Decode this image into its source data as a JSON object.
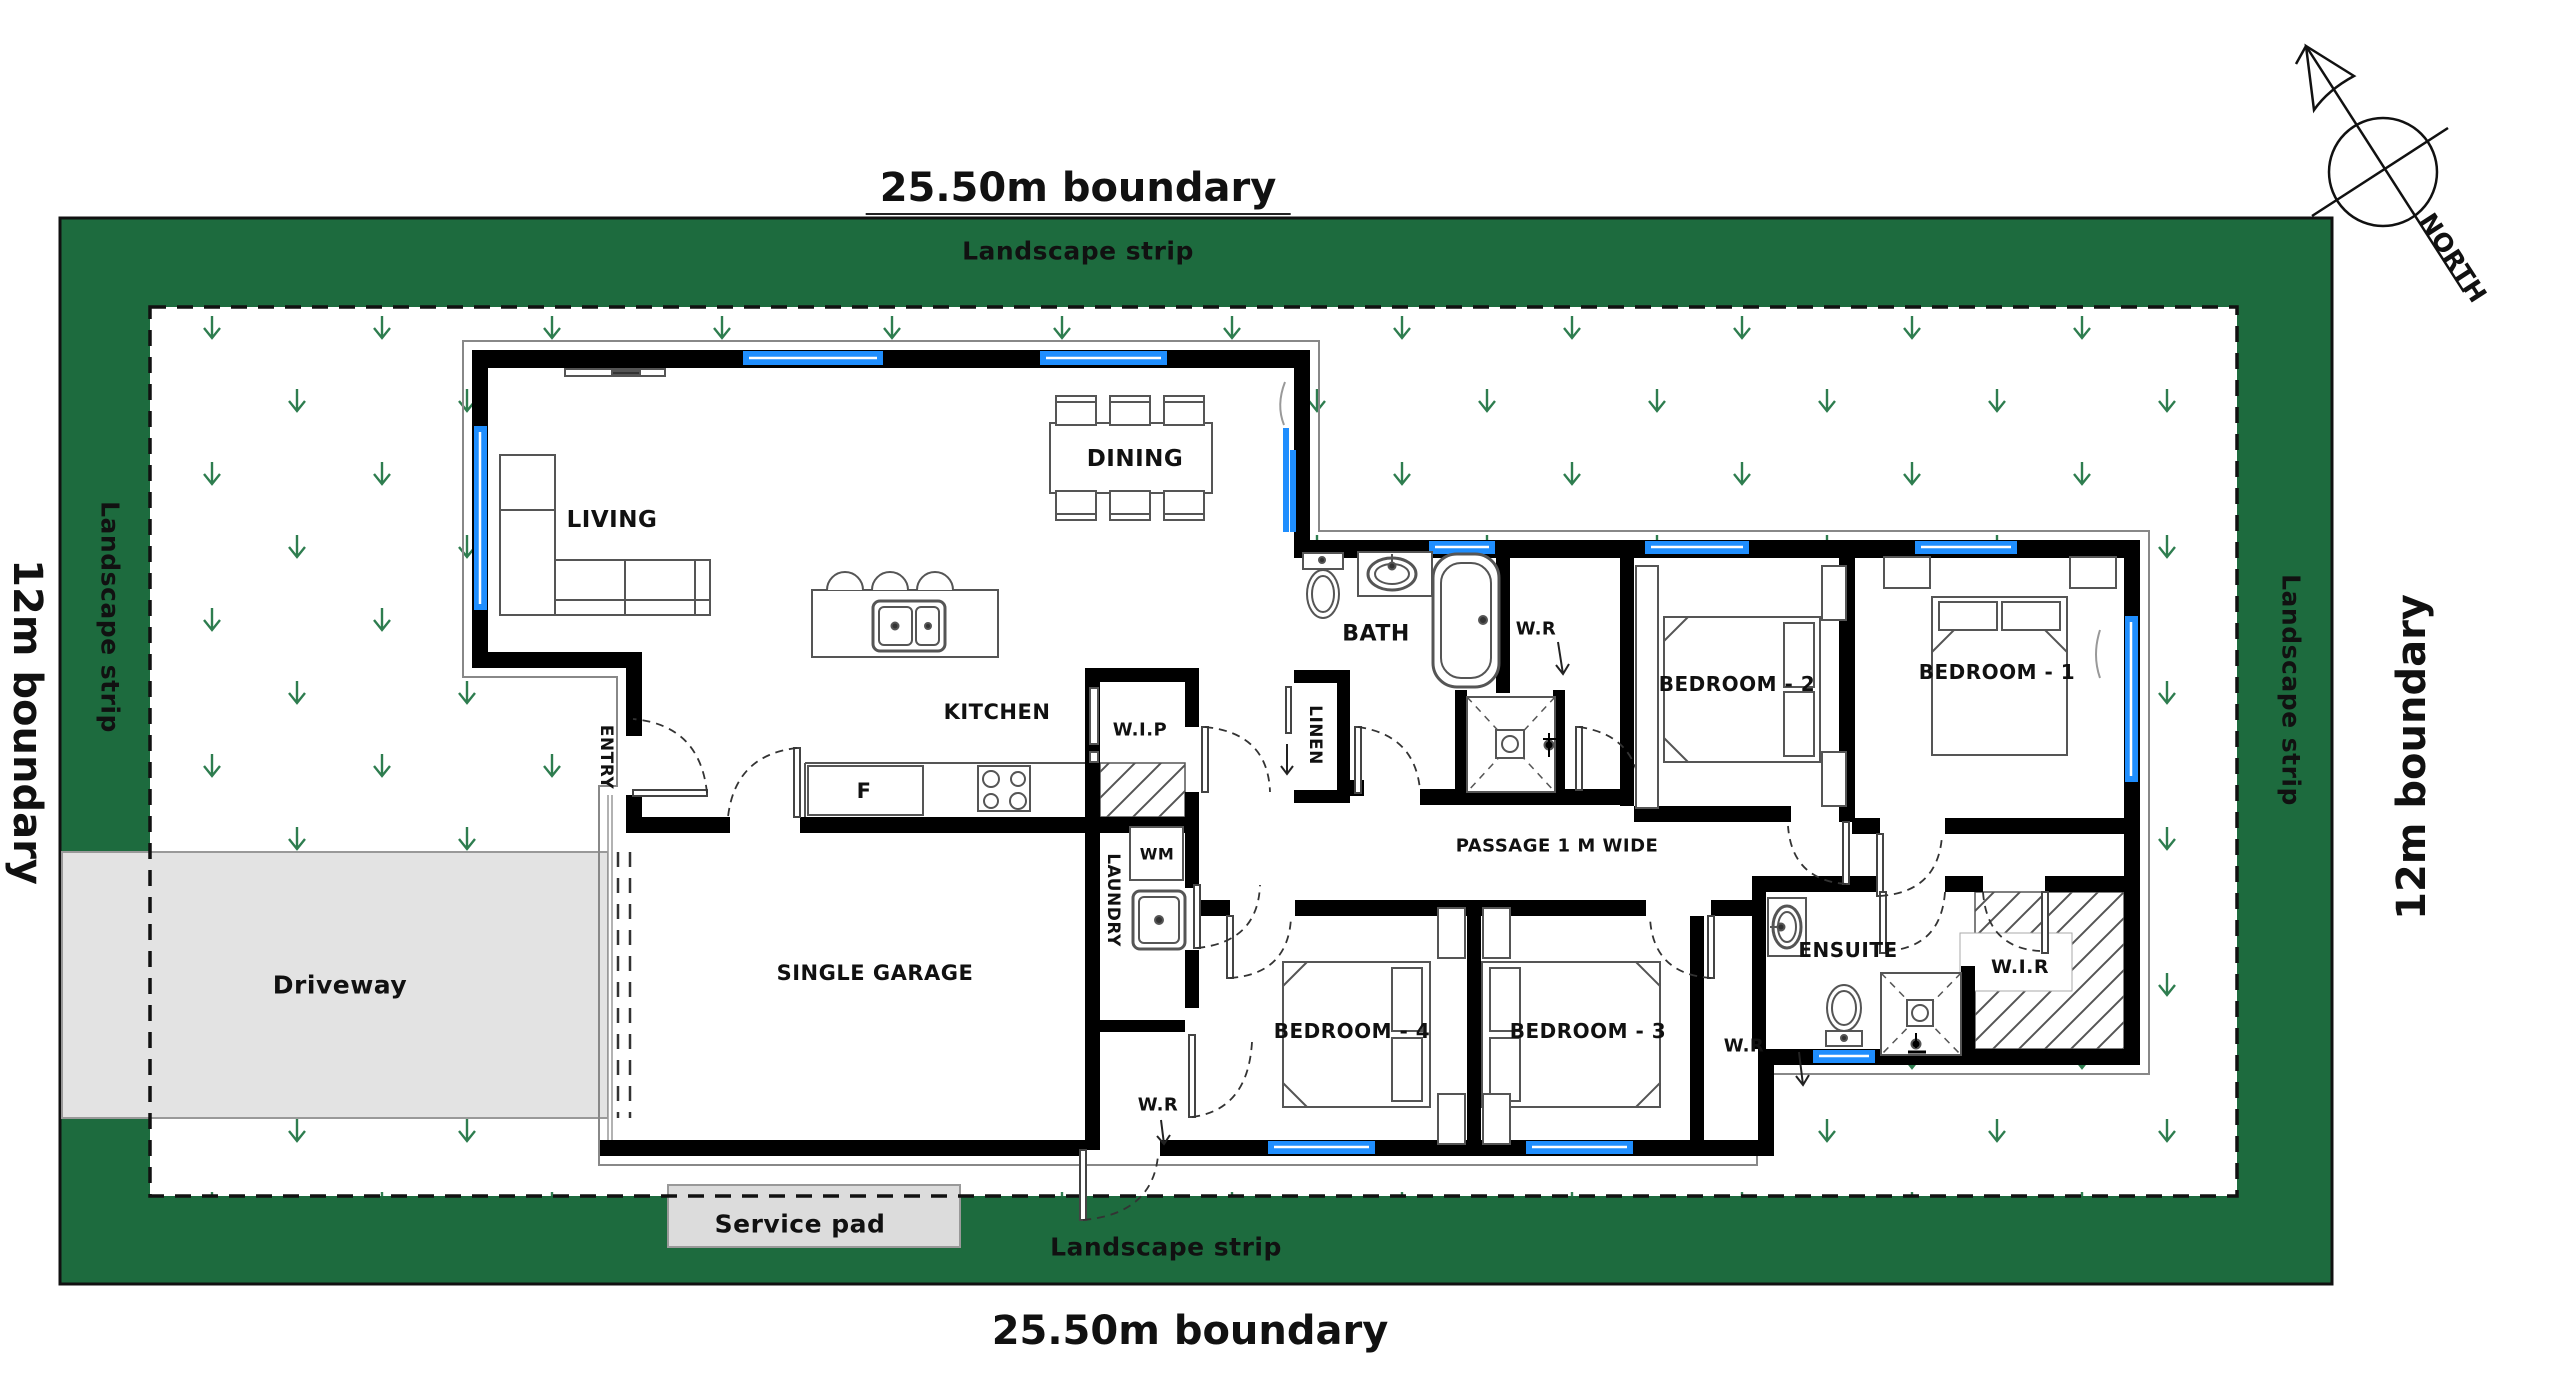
{
  "meta": {
    "title": "Residential site / floor plan",
    "colors": {
      "landscape_green": "#1d6b3e",
      "grass_symbol_green": "#2e7d4f",
      "window_blue": "#1f8efe",
      "driveway_gray": "#e3e3e3",
      "service_pad_gray": "#dcdcdc",
      "wall_black": "#000000"
    },
    "icons": [
      {
        "name": "north-compass-icon",
        "meaning": "north direction compass arrow"
      },
      {
        "name": "grass-icon",
        "meaning": "grass/landscape planting symbol"
      },
      {
        "name": "door-swing-icon",
        "meaning": "door swing arc"
      },
      {
        "name": "shower-icon",
        "meaning": "shower tray with cross"
      },
      {
        "name": "toilet-icon",
        "meaning": "toilet"
      },
      {
        "name": "bathtub-icon",
        "meaning": "bathtub"
      },
      {
        "name": "sink-icon",
        "meaning": "sink basin"
      }
    ]
  },
  "site": {
    "top_boundary": "25.50m boundary",
    "bottom_boundary": "25.50m boundary",
    "left_boundary": "12m boundary",
    "right_boundary": "12m boundary",
    "landscape_strip": "Landscape strip",
    "north_label": "NORTH"
  },
  "rooms": [
    "LIVING",
    "DINING",
    "KITCHEN",
    "ENTRY",
    "W.I.P",
    "SINGLE GARAGE",
    "LAUNDRY",
    "BATH",
    "LINEN",
    "W.R",
    "PASSAGE 1 M WIDE",
    "BEDROOM - 1",
    "BEDROOM - 2",
    "BEDROOM - 3",
    "BEDROOM - 4",
    "ENSUITE",
    "W.I.R"
  ],
  "fixtures": [
    "WM",
    "F"
  ],
  "labels": [
    {
      "name": "boundary-top",
      "text": "25.50m boundary",
      "x": 1078,
      "y": 190,
      "size": 40,
      "underline": true,
      "big": true
    },
    {
      "name": "landscape-top",
      "text": "Landscape strip",
      "x": 1078,
      "y": 251,
      "size": 25
    },
    {
      "name": "landscape-bottom",
      "text": "Landscape strip",
      "x": 1166,
      "y": 1247,
      "size": 25
    },
    {
      "name": "boundary-bottom",
      "text": "25.50m boundary",
      "x": 1190,
      "y": 1331,
      "size": 40,
      "big": true
    },
    {
      "name": "boundary-left",
      "text": "12m boundary",
      "x": 27,
      "y": 722,
      "size": 40,
      "rot": 90,
      "big": true
    },
    {
      "name": "landscape-left",
      "text": "Landscape strip",
      "x": 110,
      "y": 617,
      "size": 25,
      "rot": 90
    },
    {
      "name": "boundary-right",
      "text": "12m boundary",
      "x": 2412,
      "y": 757,
      "size": 40,
      "rot": -90,
      "big": true
    },
    {
      "name": "landscape-right",
      "text": "Landscape strip",
      "x": 2291,
      "y": 690,
      "size": 25,
      "rot": 90
    },
    {
      "name": "north",
      "text": "NORTH",
      "x": 2453,
      "y": 258,
      "size": 25,
      "rot": 57
    },
    {
      "name": "room-living",
      "text": "LIVING",
      "x": 612,
      "y": 520,
      "size": 23
    },
    {
      "name": "room-dining",
      "text": "DINING",
      "x": 1135,
      "y": 459,
      "size": 23
    },
    {
      "name": "room-kitchen",
      "text": "KITCHEN",
      "x": 997,
      "y": 712,
      "size": 21
    },
    {
      "name": "room-entry",
      "text": "ENTRY",
      "x": 606,
      "y": 757,
      "size": 17,
      "rot": 90
    },
    {
      "name": "room-wip",
      "text": "W.I.P",
      "x": 1140,
      "y": 730,
      "size": 18
    },
    {
      "name": "room-garage",
      "text": "SINGLE GARAGE",
      "x": 875,
      "y": 973,
      "size": 21
    },
    {
      "name": "room-laundry",
      "text": "LAUNDRY",
      "x": 1113,
      "y": 900,
      "size": 17,
      "rot": 90
    },
    {
      "name": "fixture-wm",
      "text": "WM",
      "x": 1157,
      "y": 854,
      "size": 16
    },
    {
      "name": "fixture-fridge",
      "text": "F",
      "x": 864,
      "y": 791,
      "size": 21
    },
    {
      "name": "room-bath",
      "text": "BATH",
      "x": 1376,
      "y": 634,
      "size": 22
    },
    {
      "name": "room-linen",
      "text": "LINEN",
      "x": 1315,
      "y": 735,
      "size": 17,
      "rot": 90
    },
    {
      "name": "room-wr-top",
      "text": "W.R",
      "x": 1536,
      "y": 629,
      "size": 18
    },
    {
      "name": "room-passage",
      "text": "PASSAGE 1 M WIDE",
      "x": 1557,
      "y": 846,
      "size": 18
    },
    {
      "name": "room-bedroom2",
      "text": "BEDROOM - 2",
      "x": 1737,
      "y": 684,
      "size": 20
    },
    {
      "name": "room-bedroom1",
      "text": "BEDROOM - 1",
      "x": 1997,
      "y": 672,
      "size": 20
    },
    {
      "name": "room-bedroom4",
      "text": "BEDROOM - 4",
      "x": 1352,
      "y": 1031,
      "size": 20
    },
    {
      "name": "room-bedroom3",
      "text": "BEDROOM - 3",
      "x": 1588,
      "y": 1031,
      "size": 20
    },
    {
      "name": "room-wr-garage",
      "text": "W.R",
      "x": 1158,
      "y": 1105,
      "size": 18
    },
    {
      "name": "room-wr-ensuite",
      "text": "W.R",
      "x": 1744,
      "y": 1046,
      "size": 18
    },
    {
      "name": "room-ensuite",
      "text": "ENSUITE",
      "x": 1848,
      "y": 950,
      "size": 20
    },
    {
      "name": "room-wir",
      "text": "W.I.R",
      "x": 2020,
      "y": 967,
      "size": 19
    },
    {
      "name": "driveway",
      "text": "Driveway",
      "x": 340,
      "y": 985,
      "size": 25
    },
    {
      "name": "service-pad",
      "text": "Service pad",
      "x": 800,
      "y": 1224,
      "size": 25
    }
  ]
}
